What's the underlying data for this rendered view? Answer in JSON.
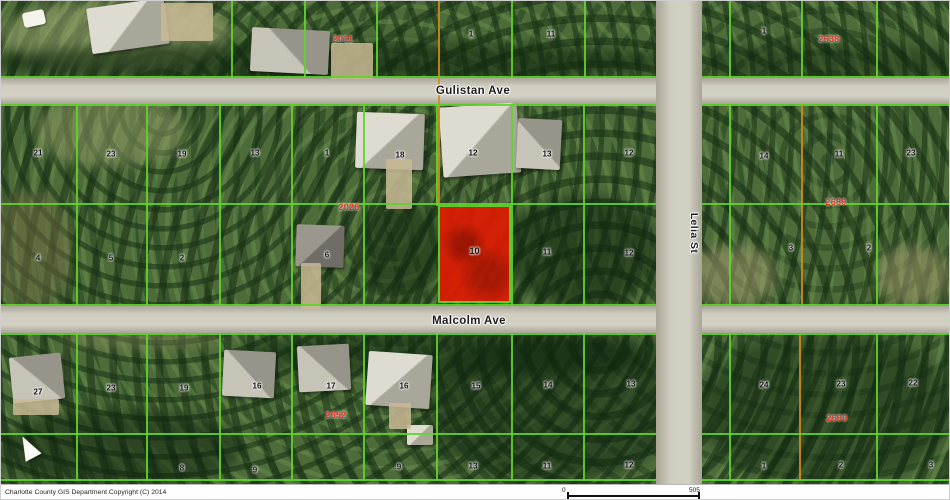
{
  "map": {
    "streets": [
      {
        "name": "Gulistan Ave",
        "x": 472,
        "y": 90,
        "vertical": false
      },
      {
        "name": "Malcolm Ave",
        "x": 468,
        "y": 320,
        "vertical": false
      },
      {
        "name": "Lelia St",
        "x": 693,
        "y": 232,
        "vertical": true
      }
    ],
    "selected_parcel": {
      "number": "10"
    },
    "block_labels": [
      {
        "text": "2011",
        "x": 342,
        "y": 38
      },
      {
        "text": "2638",
        "x": 828,
        "y": 38
      },
      {
        "text": "2026",
        "x": 348,
        "y": 206
      },
      {
        "text": "2689",
        "x": 835,
        "y": 201
      },
      {
        "text": "2652",
        "x": 335,
        "y": 414
      },
      {
        "text": "2690",
        "x": 836,
        "y": 417
      }
    ],
    "parcel_labels": [
      {
        "text": "1",
        "x": 470,
        "y": 33
      },
      {
        "text": "11",
        "x": 550,
        "y": 33
      },
      {
        "text": "1",
        "x": 763,
        "y": 30
      },
      {
        "text": "21",
        "x": 37,
        "y": 152
      },
      {
        "text": "23",
        "x": 110,
        "y": 153
      },
      {
        "text": "19",
        "x": 181,
        "y": 153
      },
      {
        "text": "13",
        "x": 254,
        "y": 152
      },
      {
        "text": "1",
        "x": 326,
        "y": 152
      },
      {
        "text": "18",
        "x": 399,
        "y": 154
      },
      {
        "text": "12",
        "x": 472,
        "y": 152
      },
      {
        "text": "13",
        "x": 546,
        "y": 153
      },
      {
        "text": "12",
        "x": 628,
        "y": 152
      },
      {
        "text": "14",
        "x": 763,
        "y": 155
      },
      {
        "text": "11",
        "x": 838,
        "y": 153
      },
      {
        "text": "23",
        "x": 910,
        "y": 152
      },
      {
        "text": "4",
        "x": 37,
        "y": 257
      },
      {
        "text": "5",
        "x": 110,
        "y": 257
      },
      {
        "text": "2",
        "x": 181,
        "y": 257
      },
      {
        "text": "6",
        "x": 326,
        "y": 254
      },
      {
        "text": "11",
        "x": 546,
        "y": 251
      },
      {
        "text": "12",
        "x": 628,
        "y": 252
      },
      {
        "text": "3",
        "x": 790,
        "y": 247
      },
      {
        "text": "2",
        "x": 868,
        "y": 247
      },
      {
        "text": "27",
        "x": 37,
        "y": 391
      },
      {
        "text": "23",
        "x": 110,
        "y": 387
      },
      {
        "text": "19",
        "x": 183,
        "y": 387
      },
      {
        "text": "16",
        "x": 256,
        "y": 385
      },
      {
        "text": "17",
        "x": 330,
        "y": 385
      },
      {
        "text": "16",
        "x": 403,
        "y": 385
      },
      {
        "text": "15",
        "x": 475,
        "y": 385
      },
      {
        "text": "14",
        "x": 547,
        "y": 384
      },
      {
        "text": "13",
        "x": 630,
        "y": 383
      },
      {
        "text": "24",
        "x": 763,
        "y": 384
      },
      {
        "text": "23",
        "x": 840,
        "y": 383
      },
      {
        "text": "22",
        "x": 912,
        "y": 382
      },
      {
        "text": "8",
        "x": 181,
        "y": 467
      },
      {
        "text": "9",
        "x": 254,
        "y": 469
      },
      {
        "text": "9",
        "x": 398,
        "y": 466
      },
      {
        "text": "13",
        "x": 472,
        "y": 465
      },
      {
        "text": "11",
        "x": 546,
        "y": 465
      },
      {
        "text": "12",
        "x": 628,
        "y": 464
      },
      {
        "text": "1",
        "x": 763,
        "y": 465
      },
      {
        "text": "2",
        "x": 840,
        "y": 464
      },
      {
        "text": "3",
        "x": 930,
        "y": 464
      }
    ]
  },
  "footer": {
    "copyright": "Charlotte County GIS Department Copyright (C) 2014",
    "scale_start": "0",
    "scale_end": "505"
  },
  "colors": {
    "parcel_line": "#5fd42c",
    "boundary_line": "#cf8a1f",
    "selected_parcel_fill": "#dd1c04",
    "block_label": "#e03322",
    "road": "#cdcabe"
  }
}
